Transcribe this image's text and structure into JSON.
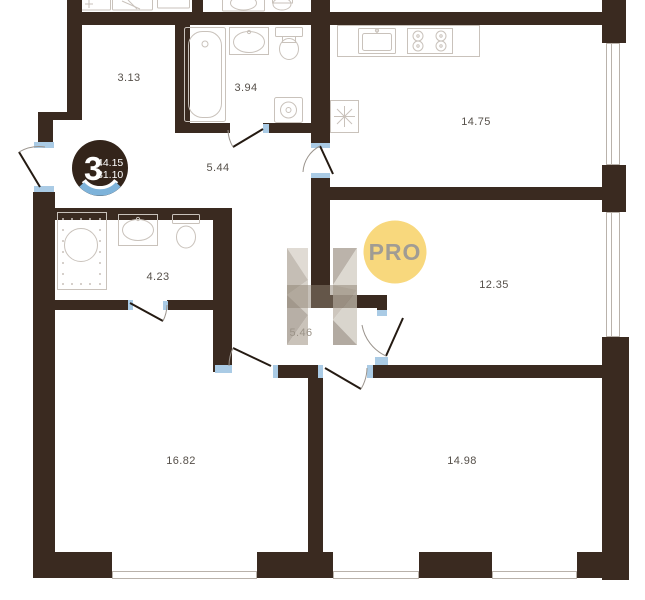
{
  "floorplan": {
    "unit_badge": {
      "rooms_count": "3",
      "upper_value": "44.15",
      "lower_value": "81.10"
    },
    "pro_badge": {
      "label": "PRO"
    },
    "rooms": [
      {
        "id": "storage-room",
        "area": "3.13"
      },
      {
        "id": "bathroom-top",
        "area": "3.94"
      },
      {
        "id": "hallway",
        "area": "5.44"
      },
      {
        "id": "kitchen-living",
        "area": "14.75"
      },
      {
        "id": "bathroom-left",
        "area": "4.23"
      },
      {
        "id": "bedroom-right",
        "area": "12.35"
      },
      {
        "id": "corridor",
        "area": "5.46"
      },
      {
        "id": "room-bottom-left",
        "area": "16.82"
      },
      {
        "id": "room-bottom-right",
        "area": "14.98"
      }
    ],
    "colors": {
      "wall": "#3a2a20",
      "badge_background": "#33241a",
      "badge_accent_blue": "#7eb3da",
      "window_jamb_blue": "#aacbe5",
      "pro_yellow": "#f8d87d",
      "pro_text": "#a09c94",
      "label_text": "#56504a",
      "corridor_label_text": "#9b9388",
      "fixture_line": "#c9c2bb",
      "watermark_beige": "#c2bab0"
    }
  }
}
